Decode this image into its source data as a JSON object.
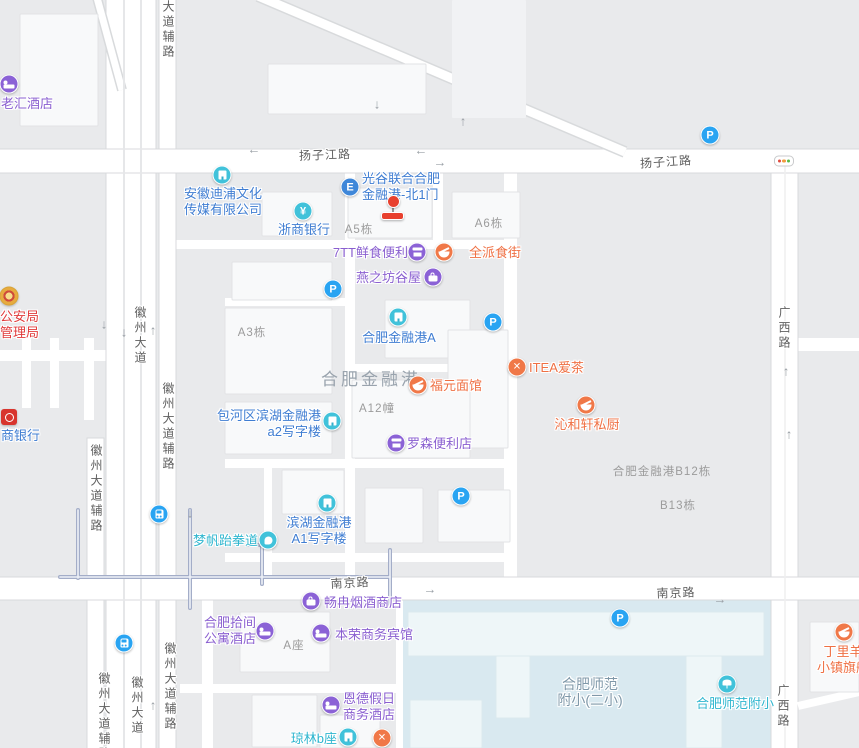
{
  "map": {
    "colors": {
      "blue": "#3f7dd2",
      "purple": "#8a5fd0",
      "orange": "#ef7044",
      "teal": "#2fb6cf",
      "red": "#e03a3a",
      "grayblue": "#7f98a9",
      "icon_purple": "#8b62d6",
      "icon_orange": "#f07848",
      "icon_teal": "#41c2da",
      "icon_blue": "#29a4f2",
      "icon_gate": "#3f87d9",
      "marker_red": "#e8402e",
      "school_area": "#d9e9f0",
      "block": "#e9eaec",
      "road": "#ffffff"
    },
    "area_labels": [
      {
        "text": "合肥金融港",
        "x": 371,
        "y": 365
      }
    ],
    "road_labels": [
      {
        "text": "扬子江路",
        "x": 325,
        "y": 146,
        "vert": false,
        "rot": -2
      },
      {
        "text": "扬子江路",
        "x": 666,
        "y": 153,
        "vert": false,
        "rot": -4
      },
      {
        "text": "南京路",
        "x": 350,
        "y": 574,
        "vert": false,
        "rot": -3
      },
      {
        "text": "南京路",
        "x": 676,
        "y": 584,
        "vert": false,
        "rot": -2
      },
      {
        "text": "大道辅路",
        "x": 168,
        "y": 0,
        "vert": true,
        "rot": 0
      },
      {
        "text": "徽州大道",
        "x": 140,
        "y": 306,
        "vert": true,
        "rot": 0
      },
      {
        "text": "徽州大道辅路",
        "x": 168,
        "y": 382,
        "vert": true,
        "rot": 0
      },
      {
        "text": "徽州大道辅路",
        "x": 96,
        "y": 444,
        "vert": true,
        "rot": 0
      },
      {
        "text": "徽州大道辅路",
        "x": 104,
        "y": 672,
        "vert": true,
        "rot": 0
      },
      {
        "text": "徽州大道",
        "x": 137,
        "y": 676,
        "vert": true,
        "rot": 0
      },
      {
        "text": "徽州大道辅路",
        "x": 170,
        "y": 642,
        "vert": true,
        "rot": 0
      },
      {
        "text": "广西路",
        "x": 784,
        "y": 306,
        "vert": true,
        "rot": 0
      },
      {
        "text": "广西路",
        "x": 783,
        "y": 684,
        "vert": true,
        "rot": 0
      }
    ],
    "building_labels": [
      {
        "text": "A5栋",
        "x": 359,
        "y": 221
      },
      {
        "text": "A6栋",
        "x": 489,
        "y": 215
      },
      {
        "text": "A3栋",
        "x": 252,
        "y": 324
      },
      {
        "text": "A12幢",
        "x": 377,
        "y": 400
      },
      {
        "text": "合肥金融港B12栋",
        "x": 662,
        "y": 463
      },
      {
        "text": "B13栋",
        "x": 678,
        "y": 497
      },
      {
        "text": "A座",
        "x": 294,
        "y": 637
      }
    ],
    "pois": [
      {
        "name": "laohui-hotel",
        "lines": [
          "老汇酒店"
        ],
        "color": "purple",
        "icon": "bed",
        "iconbg": "bg-purple",
        "ix": 9,
        "iy": 84,
        "anchor": "left",
        "tx": 1,
        "ty": 96
      },
      {
        "name": "police-bureau",
        "lines": [
          "公安局",
          "管理局"
        ],
        "color": "red",
        "icon": "badge",
        "iconbg": "",
        "ix": 9,
        "iy": 296,
        "anchor": "left",
        "tx": 0,
        "ty": 309
      },
      {
        "name": "huishang-bank",
        "lines": [
          "商银行"
        ],
        "color": "blue",
        "icon": "hsbank",
        "iconbg": "",
        "ix": 9,
        "iy": 417,
        "anchor": "left",
        "tx": 1,
        "ty": 428
      },
      {
        "name": "anhui-dipu-media",
        "lines": [
          "安徽迪浦文化",
          "传媒有限公司"
        ],
        "color": "blue",
        "icon": "bldg",
        "iconbg": "bg-teal",
        "ix": 222,
        "iy": 175,
        "anchor": "center",
        "tx": 223,
        "ty": 186
      },
      {
        "name": "zheshang-bank",
        "lines": [
          "浙商银行"
        ],
        "color": "blue",
        "icon": "yen",
        "iconbg": "bg-teal",
        "ix": 303,
        "iy": 211,
        "anchor": "center",
        "tx": 304,
        "ty": 222
      },
      {
        "name": "guanggu-north-gate1",
        "lines": [
          "光谷联合合肥",
          "金融港-北1门"
        ],
        "color": "blue",
        "icon": "gateE",
        "iconbg": "bg-gate",
        "ix": 350,
        "iy": 187,
        "anchor": "left",
        "tx": 362,
        "ty": 171
      },
      {
        "name": "7tt-convenience",
        "lines": [
          "7TT鲜食便利"
        ],
        "color": "purple",
        "icon": "shop",
        "iconbg": "bg-purple",
        "ix": 417,
        "iy": 252,
        "anchor": "right",
        "tx": 408,
        "ty": 245
      },
      {
        "name": "quanpai-food-street",
        "lines": [
          "全派食街"
        ],
        "color": "orange",
        "icon": "bowl",
        "iconbg": "bg-orange",
        "ix": 444,
        "iy": 252,
        "anchor": "left",
        "tx": 469,
        "ty": 245
      },
      {
        "name": "yanzhifang-guwu",
        "lines": [
          "燕之坊谷屋"
        ],
        "color": "purple",
        "icon": "bag",
        "iconbg": "bg-purple",
        "ix": 433,
        "iy": 277,
        "anchor": "right",
        "tx": 421,
        "ty": 270
      },
      {
        "name": "jinronggang-a",
        "lines": [
          "合肥金融港A"
        ],
        "color": "blue",
        "icon": "bldg",
        "iconbg": "bg-teal",
        "ix": 398,
        "iy": 317,
        "anchor": "center",
        "tx": 399,
        "ty": 330
      },
      {
        "name": "baohe-a2-tower",
        "lines": [
          "包河区滨湖金融港",
          "a2写字楼"
        ],
        "color": "blue",
        "icon": "bldg",
        "iconbg": "bg-teal",
        "ix": 332,
        "iy": 421,
        "anchor": "right",
        "tx": 321,
        "ty": 408
      },
      {
        "name": "lawson-store",
        "lines": [
          "罗森便利店"
        ],
        "color": "purple",
        "icon": "shop",
        "iconbg": "bg-purple",
        "ix": 396,
        "iy": 443,
        "anchor": "left",
        "tx": 407,
        "ty": 436
      },
      {
        "name": "fuyuan-noodles",
        "lines": [
          "福元面馆"
        ],
        "color": "orange",
        "icon": "bowl",
        "iconbg": "bg-orange",
        "ix": 418,
        "iy": 385,
        "anchor": "left",
        "tx": 430,
        "ty": 378
      },
      {
        "name": "itea-tea",
        "lines": [
          "ITEA爱茶"
        ],
        "color": "orange",
        "icon": "cross",
        "iconbg": "bg-orange",
        "ix": 517,
        "iy": 367,
        "anchor": "left",
        "tx": 529,
        "ty": 360
      },
      {
        "name": "qinhexuan-kitchen",
        "lines": [
          "沁和轩私厨"
        ],
        "color": "orange",
        "icon": "bowl",
        "iconbg": "bg-orange",
        "ix": 586,
        "iy": 405,
        "anchor": "center",
        "tx": 587,
        "ty": 417
      },
      {
        "name": "mengfan-taekwondo",
        "lines": [
          "梦帆跆拳道"
        ],
        "color": "teal",
        "icon": "fist",
        "iconbg": "bg-teal",
        "ix": 268,
        "iy": 540,
        "anchor": "right",
        "tx": 258,
        "ty": 533
      },
      {
        "name": "binhu-a1-tower",
        "lines": [
          "滨湖金融港",
          "A1写字楼"
        ],
        "color": "blue",
        "icon": "bldg",
        "iconbg": "bg-teal",
        "ix": 327,
        "iy": 503,
        "anchor": "center",
        "tx": 319,
        "ty": 515
      },
      {
        "name": "changran-tobacco",
        "lines": [
          "畅冉烟酒商店"
        ],
        "color": "purple",
        "icon": "bag",
        "iconbg": "bg-purple",
        "ix": 311,
        "iy": 601,
        "anchor": "left",
        "tx": 324,
        "ty": 595
      },
      {
        "name": "hefei-shijian-hotel",
        "lines": [
          "合肥拾间",
          "公寓酒店"
        ],
        "color": "purple",
        "icon": "bed",
        "iconbg": "bg-purple",
        "ix": 265,
        "iy": 631,
        "anchor": "right",
        "tx": 256,
        "ty": 615
      },
      {
        "name": "benrong-hotel",
        "lines": [
          "本荣商务宾馆"
        ],
        "color": "purple",
        "icon": "bed",
        "iconbg": "bg-purple",
        "ix": 321,
        "iy": 633,
        "anchor": "left",
        "tx": 335,
        "ty": 627
      },
      {
        "name": "ende-holiday-hotel",
        "lines": [
          "恩德假日",
          "商务酒店"
        ],
        "color": "purple",
        "icon": "bed",
        "iconbg": "bg-purple",
        "ix": 331,
        "iy": 705,
        "anchor": "left",
        "tx": 343,
        "ty": 691
      },
      {
        "name": "qionglin-b",
        "lines": [
          "琼林b座"
        ],
        "color": "teal",
        "icon": "bldg",
        "iconbg": "bg-teal",
        "ix": 348,
        "iy": 737,
        "anchor": "right",
        "tx": 337,
        "ty": 731
      },
      {
        "name": "restaurant-marker",
        "lines": [],
        "color": "orange",
        "icon": "cross",
        "iconbg": "bg-orange",
        "ix": 382,
        "iy": 738,
        "anchor": "left",
        "tx": 0,
        "ty": 0
      },
      {
        "name": "shifan-primary-2",
        "lines": [
          "合肥师范",
          "附小(二小)"
        ],
        "color": "grayblue",
        "icon": "",
        "iconbg": "",
        "ix": 0,
        "iy": 0,
        "anchor": "center",
        "tx": 590,
        "ty": 677,
        "size": 14
      },
      {
        "name": "shifan-fuxiao",
        "lines": [
          "合肥师范附小"
        ],
        "color": "teal",
        "icon": "tree",
        "iconbg": "bg-teal",
        "ix": 727,
        "iy": 684,
        "anchor": "center",
        "tx": 735,
        "ty": 696
      },
      {
        "name": "dingliyang-flagship",
        "lines": [
          "丁里羊",
          "小镇旗舰"
        ],
        "color": "orange",
        "icon": "bowl",
        "iconbg": "bg-orange",
        "ix": 844,
        "iy": 632,
        "anchor": "center",
        "tx": 843,
        "ty": 644
      }
    ],
    "parkings": [
      {
        "x": 710,
        "y": 135
      },
      {
        "x": 333,
        "y": 289
      },
      {
        "x": 493,
        "y": 322
      },
      {
        "x": 461,
        "y": 496
      },
      {
        "x": 620,
        "y": 618
      }
    ],
    "parking_letter": "P",
    "gate_letter": "E",
    "yen_symbol": "¥",
    "cross_symbol": "✕",
    "metros": [
      {
        "x": 159,
        "y": 514
      },
      {
        "x": 124,
        "y": 643
      }
    ],
    "traffic_light": {
      "x": 784,
      "y": 161
    },
    "gate_marker": {
      "x": 393,
      "y": 197
    },
    "arrows": [
      {
        "x": 377,
        "y": 104,
        "dir": "down"
      },
      {
        "x": 463,
        "y": 121,
        "dir": "up"
      },
      {
        "x": 254,
        "y": 149,
        "dir": "left"
      },
      {
        "x": 421,
        "y": 150,
        "dir": "left"
      },
      {
        "x": 440,
        "y": 162,
        "dir": "right"
      },
      {
        "x": 104,
        "y": 324,
        "dir": "down"
      },
      {
        "x": 124,
        "y": 332,
        "dir": "down"
      },
      {
        "x": 153,
        "y": 330,
        "dir": "up"
      },
      {
        "x": 190,
        "y": 513,
        "dir": "down"
      },
      {
        "x": 153,
        "y": 705,
        "dir": "up"
      },
      {
        "x": 786,
        "y": 371,
        "dir": "up"
      },
      {
        "x": 789,
        "y": 434,
        "dir": "up"
      },
      {
        "x": 430,
        "y": 589,
        "dir": "right"
      },
      {
        "x": 720,
        "y": 599,
        "dir": "right"
      }
    ]
  }
}
